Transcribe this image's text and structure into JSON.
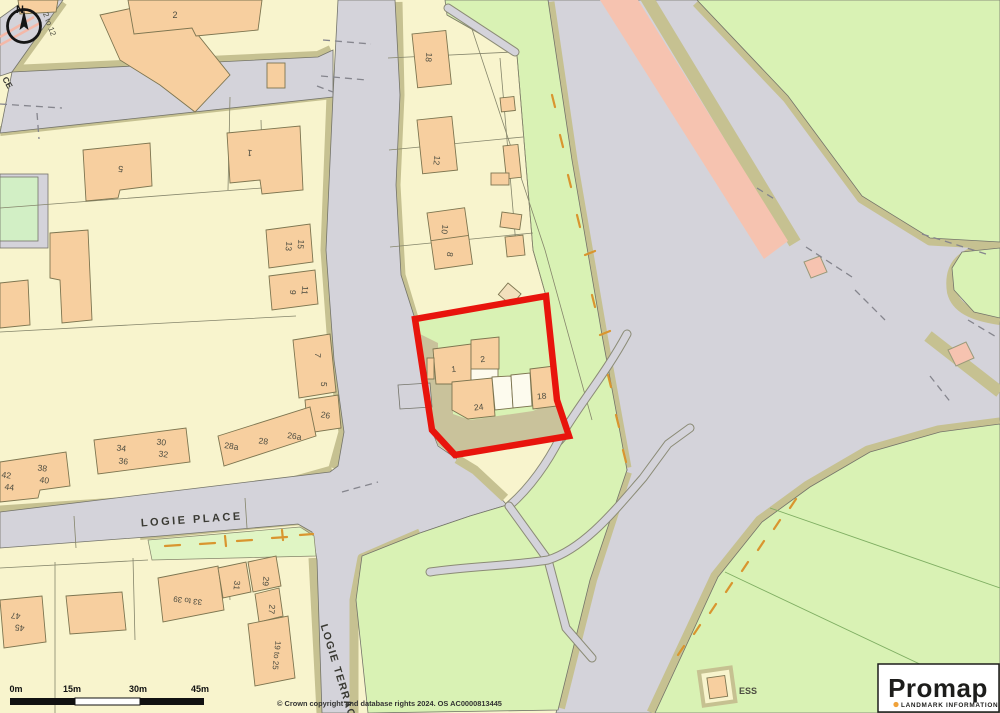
{
  "colors": {
    "cream": "#f8f4cd",
    "road": "#d4d3da",
    "verge": "#c6c191",
    "green": "#d9f2b4",
    "green2": "#e0f5c4",
    "orange": "#f7cf9f",
    "outline": "#7d7550",
    "red": "#e8140c",
    "salmon": "#f6c3b0",
    "yard": "#c9c29b",
    "pathorange": "#d9952f",
    "ink": "#1d1d1b"
  },
  "map": {
    "site_highlight_color": "#e8140c",
    "labels": [
      {
        "t": "N",
        "x": 20,
        "y": 13,
        "r": 0,
        "s": 11,
        "cls": "ink b",
        "name": "compass-n-label"
      },
      {
        "t": "2 to 12",
        "x": 47,
        "y": 25,
        "r": 70,
        "s": 8
      },
      {
        "t": "2",
        "x": 175,
        "y": 18,
        "r": 0,
        "s": 9
      },
      {
        "t": "5",
        "x": 121,
        "y": 166,
        "r": 187,
        "s": 9
      },
      {
        "t": "1",
        "x": 250,
        "y": 150,
        "r": 187,
        "s": 9
      },
      {
        "t": "13",
        "x": 286,
        "y": 246,
        "r": 96,
        "s": 8.5
      },
      {
        "t": "15",
        "x": 298,
        "y": 244,
        "r": 96,
        "s": 8.5
      },
      {
        "t": "9",
        "x": 290,
        "y": 292,
        "r": 96,
        "s": 8.5
      },
      {
        "t": "11",
        "x": 302,
        "y": 290,
        "r": 96,
        "s": 8.5
      },
      {
        "t": "7",
        "x": 315,
        "y": 355,
        "r": 96,
        "s": 8.5
      },
      {
        "t": "5",
        "x": 321,
        "y": 384,
        "r": 96,
        "s": 8.5
      },
      {
        "t": "26",
        "x": 325,
        "y": 418,
        "r": 10,
        "s": 8.5
      },
      {
        "t": "26a",
        "x": 294,
        "y": 439,
        "r": 8,
        "s": 8.5
      },
      {
        "t": "28",
        "x": 263,
        "y": 444,
        "r": 8,
        "s": 8.5
      },
      {
        "t": "28a",
        "x": 231,
        "y": 449,
        "r": 8,
        "s": 8.5
      },
      {
        "t": "30",
        "x": 161,
        "y": 445,
        "r": 8,
        "s": 8.5
      },
      {
        "t": "32",
        "x": 163,
        "y": 457,
        "r": 8,
        "s": 8.5
      },
      {
        "t": "34",
        "x": 121,
        "y": 451,
        "r": 8,
        "s": 8.5
      },
      {
        "t": "36",
        "x": 123,
        "y": 464,
        "r": 8,
        "s": 8.5
      },
      {
        "t": "38",
        "x": 42,
        "y": 471,
        "r": 8,
        "s": 8.5
      },
      {
        "t": "40",
        "x": 44,
        "y": 483,
        "r": 8,
        "s": 8.5
      },
      {
        "t": "42",
        "x": 6,
        "y": 478,
        "r": 8,
        "s": 8.5
      },
      {
        "t": "44",
        "x": 9,
        "y": 490,
        "r": 8,
        "s": 8.5
      },
      {
        "t": "47",
        "x": 16,
        "y": 613,
        "r": 187,
        "s": 8.5
      },
      {
        "t": "45",
        "x": 20,
        "y": 625,
        "r": 187,
        "s": 8.5
      },
      {
        "t": "33 to 39",
        "x": 188,
        "y": 598,
        "r": 187,
        "s": 8
      },
      {
        "t": "31",
        "x": 234,
        "y": 585,
        "r": 96,
        "s": 8.5
      },
      {
        "t": "29",
        "x": 263,
        "y": 581,
        "r": 96,
        "s": 8.5
      },
      {
        "t": "27",
        "x": 269,
        "y": 609,
        "r": 96,
        "s": 8.5
      },
      {
        "t": "19 to 25",
        "x": 274,
        "y": 655,
        "r": 96,
        "s": 8
      },
      {
        "t": "18",
        "x": 426,
        "y": 57,
        "r": 96,
        "s": 8.5
      },
      {
        "t": "12",
        "x": 434,
        "y": 160,
        "r": 98,
        "s": 8.5
      },
      {
        "t": "10",
        "x": 442,
        "y": 229,
        "r": 98,
        "s": 8.5
      },
      {
        "t": "8",
        "x": 447,
        "y": 254,
        "r": 98,
        "s": 8.5
      },
      {
        "t": "1",
        "x": 454,
        "y": 372,
        "r": -6,
        "s": 8.5
      },
      {
        "t": "2",
        "x": 483,
        "y": 362,
        "r": -6,
        "s": 8.5
      },
      {
        "t": "24",
        "x": 479,
        "y": 410,
        "r": -6,
        "s": 8.5
      },
      {
        "t": "18",
        "x": 542,
        "y": 399,
        "r": -6,
        "s": 8.5
      },
      {
        "t": "ESS",
        "x": 748,
        "y": 694,
        "r": 0,
        "s": 9,
        "cls": "b",
        "name": "ess-label"
      },
      {
        "t": "LOGIE  PLACE",
        "x": 192,
        "y": 523,
        "r": -4,
        "s": 11,
        "ls": 2.5,
        "cls": "street",
        "name": "street-label-logie-place"
      },
      {
        "t": "LOGIE TERRACE",
        "x": 336,
        "y": 676,
        "r": 73,
        "s": 10.5,
        "ls": 1.5,
        "cls": "street",
        "name": "street-label-logie-terrace"
      },
      {
        "t": "CE",
        "x": 5,
        "y": 84,
        "r": 60,
        "s": 8.5,
        "cls": "street"
      }
    ]
  },
  "scale_bar": {
    "labels": [
      "0m",
      "15m",
      "30m",
      "45m"
    ]
  },
  "copyright": "© Crown copyright and database rights 2024. OS AC0000813445",
  "logo": {
    "brand": "Promap",
    "subtitle": "LANDMARK INFORMATION"
  }
}
